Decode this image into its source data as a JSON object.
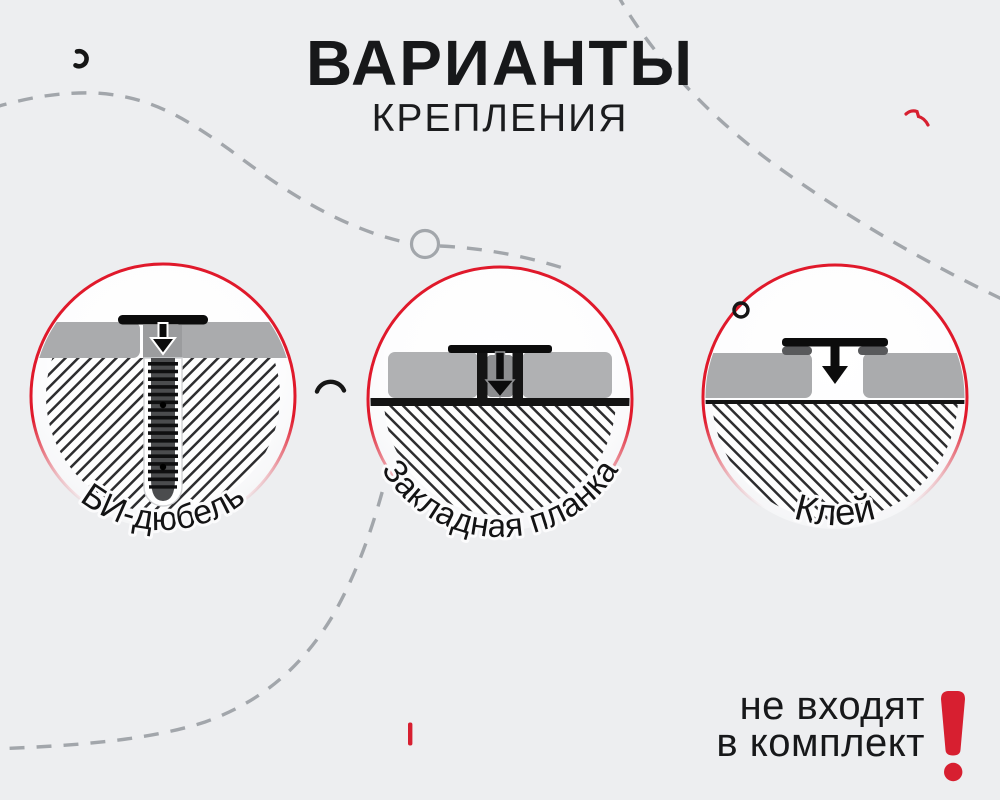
{
  "title": {
    "line1": "ВАРИАНТЫ",
    "line2": "КРЕПЛЕНИЯ"
  },
  "variants": [
    {
      "label": "БИ-дюбель",
      "icon": "bi-dowel-diagram"
    },
    {
      "label": "Закладная планка",
      "icon": "mounting-strip-diagram"
    },
    {
      "label": "Клей",
      "icon": "glue-diagram"
    }
  ],
  "note": {
    "line1": "не входят",
    "line2": "в комплект",
    "exclamation": "!"
  },
  "colors": {
    "background": "#edeef0",
    "ring_red": "#e0192b",
    "accent_red": "#d71f30",
    "panel_gray": "#aaabad",
    "dash_gray": "#a2a6ab",
    "ink": "#17181a"
  }
}
